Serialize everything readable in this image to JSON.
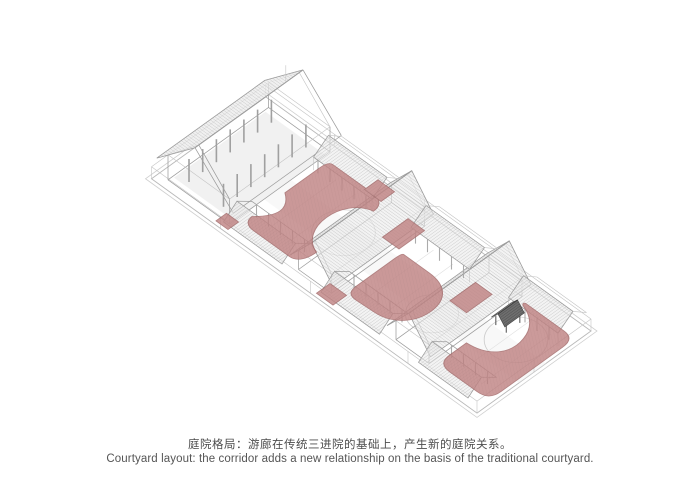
{
  "figure": {
    "kind": "axonometric-courtyard-diagram",
    "caption_zh": "庭院格局：游廊在传统三进院的基础上，产生新的庭院关系。",
    "caption_en": "Courtyard layout: the corridor adds a new relationship on the basis of the traditional courtyard.",
    "parts": [
      "rear-hall",
      "courtyard-1",
      "middle-hall-1",
      "courtyard-2",
      "middle-hall-2",
      "courtyard-3",
      "side-wings",
      "pavilion",
      "front-wall"
    ],
    "colors": {
      "background": "#ffffff",
      "courtyard_fill": "#c08484",
      "courtyard_stroke": "#a26767",
      "courtyard_hatch": "#a87272",
      "line": "#9c9c9c",
      "line_light": "#c4c4c4",
      "roof_fill": "#ebebeb",
      "roof_hatch": "#b3b3b3",
      "floor_fill": "#ededed",
      "pavilion_roof": "#6e6e6e",
      "pavilion_roof_far": "#8c8c8c",
      "pavilion_hatch": "#3f3f3f",
      "caption_color": "#4d4d4d"
    }
  }
}
